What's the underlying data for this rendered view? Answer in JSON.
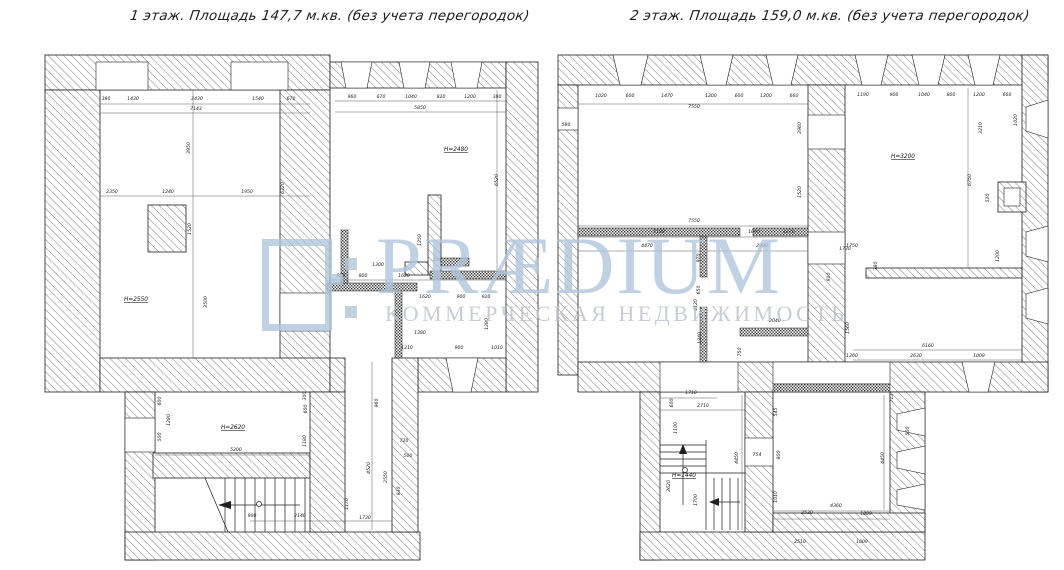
{
  "watermark": {
    "brand": "PRÆDIUM",
    "tagline": "КОММЕРЧЕСКАЯ НЕДВИЖИМОСТЬ",
    "color": "#adc4db"
  },
  "plans": [
    {
      "id": "floor1",
      "title": "1 этаж. Площадь 147,7 м.кв. (без учета перегородок)",
      "room_labels": [
        {
          "t": "Н=2550",
          "x": 136,
          "y": 301
        },
        {
          "t": "Н=2480",
          "x": 456,
          "y": 151
        },
        {
          "t": "Н=2620",
          "x": 233,
          "y": 429
        }
      ],
      "dims": [
        {
          "t": "380",
          "x": 106,
          "y": 100
        },
        {
          "t": "1430",
          "x": 133,
          "y": 100
        },
        {
          "t": "2430",
          "x": 197,
          "y": 100
        },
        {
          "t": "1540",
          "x": 258,
          "y": 100
        },
        {
          "t": "670",
          "x": 291,
          "y": 100
        },
        {
          "t": "7143",
          "x": 196,
          "y": 110
        },
        {
          "t": "960",
          "x": 352,
          "y": 98
        },
        {
          "t": "670",
          "x": 381,
          "y": 98
        },
        {
          "t": "1040",
          "x": 411,
          "y": 98
        },
        {
          "t": "820",
          "x": 441,
          "y": 98
        },
        {
          "t": "1200",
          "x": 470,
          "y": 98
        },
        {
          "t": "380",
          "x": 497,
          "y": 98
        },
        {
          "t": "5850",
          "x": 420,
          "y": 109
        },
        {
          "t": "3950",
          "x": 190,
          "y": 148,
          "r": 1
        },
        {
          "t": "6320",
          "x": 284,
          "y": 188,
          "r": 1
        },
        {
          "t": "6520",
          "x": 498,
          "y": 180,
          "r": 1
        },
        {
          "t": "1520",
          "x": 191,
          "y": 229,
          "r": 1
        },
        {
          "t": "3500",
          "x": 207,
          "y": 302,
          "r": 1
        },
        {
          "t": "1280",
          "x": 488,
          "y": 324,
          "r": 1
        },
        {
          "t": "2350",
          "x": 112,
          "y": 193
        },
        {
          "t": "1240",
          "x": 168,
          "y": 193
        },
        {
          "t": "1950",
          "x": 247,
          "y": 193
        },
        {
          "t": "1300",
          "x": 378,
          "y": 266
        },
        {
          "t": "870",
          "x": 341,
          "y": 277
        },
        {
          "t": "800",
          "x": 363,
          "y": 277
        },
        {
          "t": "1620",
          "x": 404,
          "y": 277
        },
        {
          "t": "150",
          "x": 437,
          "y": 261
        },
        {
          "t": "1250",
          "x": 421,
          "y": 240,
          "r": 1
        },
        {
          "t": "1620",
          "x": 425,
          "y": 298
        },
        {
          "t": "900",
          "x": 461,
          "y": 298
        },
        {
          "t": "920",
          "x": 486,
          "y": 298
        },
        {
          "t": "1380",
          "x": 420,
          "y": 334
        },
        {
          "t": "1210",
          "x": 407,
          "y": 349
        },
        {
          "t": "900",
          "x": 459,
          "y": 349
        },
        {
          "t": "1010",
          "x": 497,
          "y": 349
        },
        {
          "t": "600",
          "x": 161,
          "y": 401,
          "r": 1
        },
        {
          "t": "1280",
          "x": 170,
          "y": 420,
          "r": 1
        },
        {
          "t": "500",
          "x": 161,
          "y": 437,
          "r": 1
        },
        {
          "t": "5200",
          "x": 236,
          "y": 451
        },
        {
          "t": "300",
          "x": 306,
          "y": 396,
          "r": 1
        },
        {
          "t": "600",
          "x": 307,
          "y": 409,
          "r": 1
        },
        {
          "t": "1180",
          "x": 306,
          "y": 441,
          "r": 1
        },
        {
          "t": "900",
          "x": 252,
          "y": 517
        },
        {
          "t": "2140",
          "x": 300,
          "y": 517
        },
        {
          "t": "1730",
          "x": 365,
          "y": 519
        },
        {
          "t": "1170",
          "x": 348,
          "y": 504,
          "r": 1
        },
        {
          "t": "4520",
          "x": 370,
          "y": 468,
          "r": 1
        },
        {
          "t": "2550",
          "x": 387,
          "y": 477,
          "r": 1
        },
        {
          "t": "930",
          "x": 400,
          "y": 491,
          "r": 1
        },
        {
          "t": "960",
          "x": 378,
          "y": 403,
          "r": 1
        },
        {
          "t": "720",
          "x": 404,
          "y": 442
        },
        {
          "t": "500",
          "x": 408,
          "y": 457
        }
      ]
    },
    {
      "id": "floor2",
      "title": "2 этаж. Площадь 159,0 м.кв. (без учета перегородок)",
      "room_labels": [
        {
          "t": "Н=3200",
          "x": 903,
          "y": 158
        },
        {
          "t": "Н=1440",
          "x": 684,
          "y": 477
        }
      ],
      "dims": [
        {
          "t": "580",
          "x": 566,
          "y": 126
        },
        {
          "t": "1020",
          "x": 601,
          "y": 97
        },
        {
          "t": "600",
          "x": 630,
          "y": 97
        },
        {
          "t": "1470",
          "x": 667,
          "y": 97
        },
        {
          "t": "1200",
          "x": 711,
          "y": 97
        },
        {
          "t": "600",
          "x": 739,
          "y": 97
        },
        {
          "t": "1200",
          "x": 766,
          "y": 97
        },
        {
          "t": "660",
          "x": 794,
          "y": 97
        },
        {
          "t": "7550",
          "x": 694,
          "y": 108
        },
        {
          "t": "1190",
          "x": 863,
          "y": 96
        },
        {
          "t": "900",
          "x": 894,
          "y": 96
        },
        {
          "t": "1040",
          "x": 924,
          "y": 96
        },
        {
          "t": "800",
          "x": 951,
          "y": 96
        },
        {
          "t": "1200",
          "x": 979,
          "y": 96
        },
        {
          "t": "660",
          "x": 1007,
          "y": 96
        },
        {
          "t": "2960",
          "x": 801,
          "y": 128,
          "r": 1
        },
        {
          "t": "1520",
          "x": 801,
          "y": 192,
          "r": 1
        },
        {
          "t": "3210",
          "x": 982,
          "y": 128,
          "r": 1
        },
        {
          "t": "6750",
          "x": 971,
          "y": 180,
          "r": 1
        },
        {
          "t": "520",
          "x": 989,
          "y": 198,
          "r": 1
        },
        {
          "t": "1200",
          "x": 999,
          "y": 256,
          "r": 1
        },
        {
          "t": "1020",
          "x": 1017,
          "y": 120,
          "r": 1
        },
        {
          "t": "7550",
          "x": 694,
          "y": 222
        },
        {
          "t": "5180",
          "x": 659,
          "y": 233
        },
        {
          "t": "1090",
          "x": 754,
          "y": 233
        },
        {
          "t": "1270",
          "x": 789,
          "y": 233
        },
        {
          "t": "4470",
          "x": 647,
          "y": 247
        },
        {
          "t": "2990",
          "x": 762,
          "y": 247
        },
        {
          "t": "970",
          "x": 700,
          "y": 258,
          "r": 1
        },
        {
          "t": "650",
          "x": 700,
          "y": 290,
          "r": 1
        },
        {
          "t": "4120",
          "x": 697,
          "y": 305,
          "r": 1
        },
        {
          "t": "1340",
          "x": 701,
          "y": 338,
          "r": 1
        },
        {
          "t": "2040",
          "x": 775,
          "y": 322
        },
        {
          "t": "750",
          "x": 741,
          "y": 352,
          "r": 1
        },
        {
          "t": "1750",
          "x": 852,
          "y": 247
        },
        {
          "t": "380",
          "x": 877,
          "y": 266,
          "r": 1
        },
        {
          "t": "910",
          "x": 830,
          "y": 277,
          "r": 1
        },
        {
          "t": "1730",
          "x": 845,
          "y": 250
        },
        {
          "t": "1560",
          "x": 849,
          "y": 328,
          "r": 1
        },
        {
          "t": "6160",
          "x": 928,
          "y": 347
        },
        {
          "t": "1260",
          "x": 852,
          "y": 357
        },
        {
          "t": "2630",
          "x": 916,
          "y": 357
        },
        {
          "t": "1009",
          "x": 979,
          "y": 357
        },
        {
          "t": "1710",
          "x": 691,
          "y": 394
        },
        {
          "t": "2710",
          "x": 703,
          "y": 407
        },
        {
          "t": "600",
          "x": 673,
          "y": 403,
          "r": 1
        },
        {
          "t": "1100",
          "x": 677,
          "y": 428,
          "r": 1
        },
        {
          "t": "2620",
          "x": 670,
          "y": 486,
          "r": 1
        },
        {
          "t": "1700",
          "x": 697,
          "y": 500,
          "r": 1
        },
        {
          "t": "754",
          "x": 757,
          "y": 456
        },
        {
          "t": "4450",
          "x": 738,
          "y": 458,
          "r": 1
        },
        {
          "t": "545",
          "x": 777,
          "y": 412,
          "r": 1
        },
        {
          "t": "800",
          "x": 780,
          "y": 455,
          "r": 1
        },
        {
          "t": "1010",
          "x": 777,
          "y": 497,
          "r": 1
        },
        {
          "t": "2530",
          "x": 807,
          "y": 514
        },
        {
          "t": "4360",
          "x": 836,
          "y": 507
        },
        {
          "t": "1009",
          "x": 866,
          "y": 515
        },
        {
          "t": "4450",
          "x": 884,
          "y": 458,
          "r": 1
        },
        {
          "t": "713",
          "x": 893,
          "y": 398,
          "r": 1
        },
        {
          "t": "500",
          "x": 909,
          "y": 431,
          "r": 1
        },
        {
          "t": "2510",
          "x": 800,
          "y": 543
        },
        {
          "t": "1009",
          "x": 862,
          "y": 543
        }
      ]
    }
  ]
}
